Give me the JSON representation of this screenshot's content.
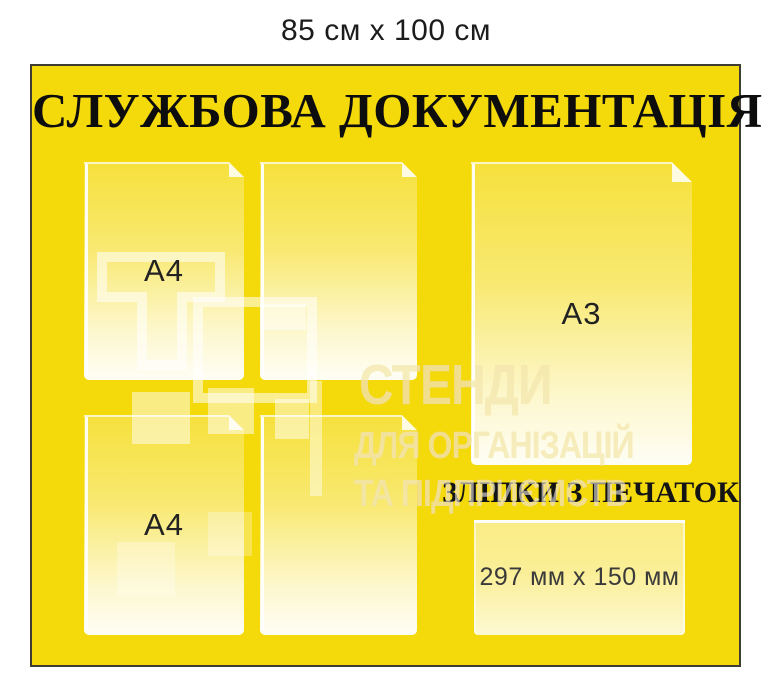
{
  "caption": "85 см x 100 см",
  "board": {
    "title": "СЛУЖБОВА ДОКУМЕНТАЦІЯ",
    "stamps_section_title": "ЗЛІПКИ З ПЕЧАТОК",
    "pocket_labels": {
      "a4_top": "А4",
      "a4_bottom": "А4",
      "a3": "А3",
      "stamps_pocket": "297 мм x 150 мм"
    },
    "watermark": {
      "line1": "СТЕНДИ",
      "line2": "ДЛЯ ОРГАНІЗАЦІЙ",
      "line3": "ТА ПІДПРИЄМСТВ"
    },
    "colors": {
      "board_yellow": "#F4D90B",
      "board_border": "#3F3D33",
      "title_text": "#0D0D0D",
      "label_text": "#222222",
      "pocket_gradient_bottom": "#FFFFFF",
      "watermark_white": "rgba(255,255,255,0.55)"
    }
  }
}
